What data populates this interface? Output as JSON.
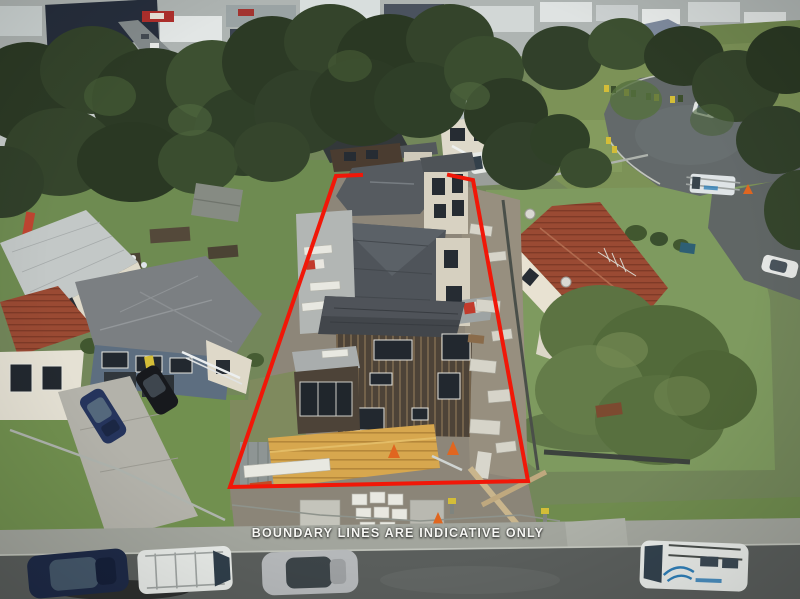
{
  "overlay": {
    "caption": "BOUNDARY LINES ARE INDICATIVE ONLY",
    "boundary_path": "M361,175 L336,176 L230,487 L528,481 L473,180 L449,175"
  },
  "palette": {
    "boundary_red": "#f11708",
    "caption_white": "#f7f7f4",
    "grass_green": "#718d50",
    "asphalt_grey": "#5d615e",
    "roof_shingle_grey": "#474b50",
    "roof_terracotta": "#9a4a33",
    "timber_yellow": "#d7a74e",
    "cladding_brown": "#4d4338",
    "van_blue_accent": "#2f7fb8"
  }
}
